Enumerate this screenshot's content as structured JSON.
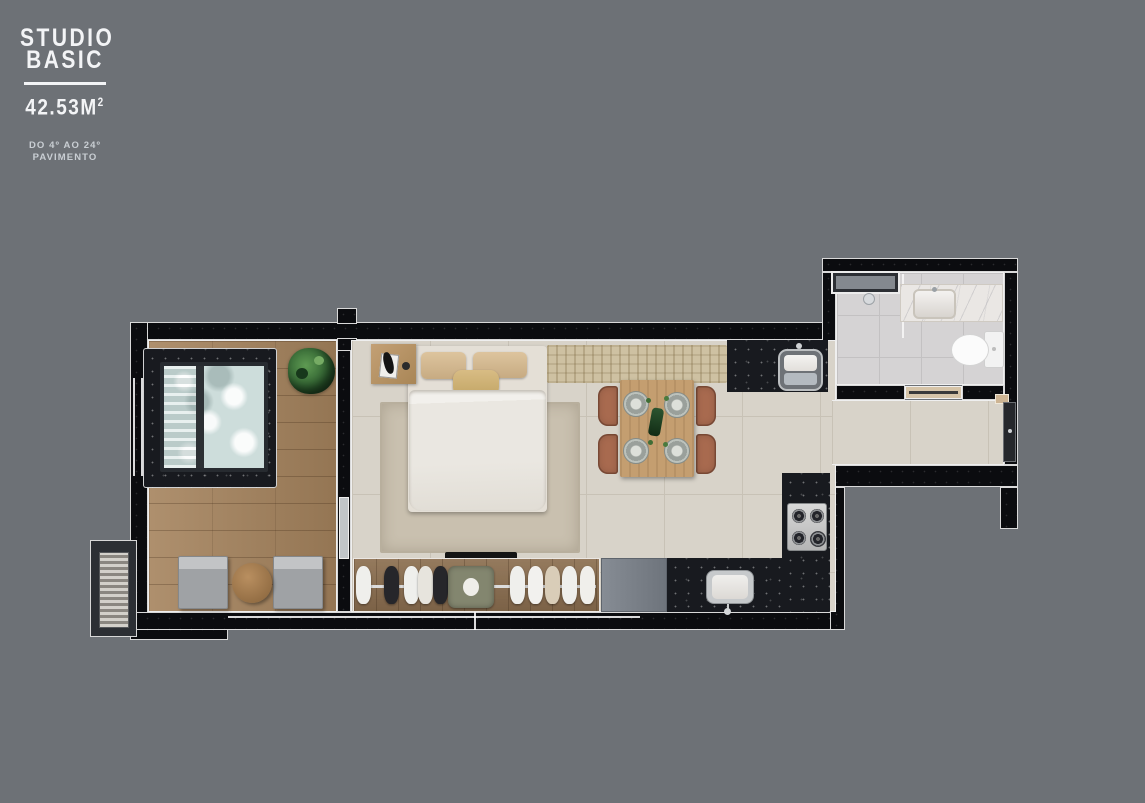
{
  "panel": {
    "title_line1": "STUDIO",
    "title_line2": "BASIC",
    "area_value": "42.53M",
    "area_superscript": "2",
    "floor_range_line1": "DO 4º AO 24º",
    "floor_range_line2": "PAVIMENTO"
  },
  "colors": {
    "background": "#6d7176",
    "wall": "#0b0c0f",
    "wall_outline": "#d9d9d9",
    "tile_floor": "#d8d3c9",
    "wood_deck": "#a5835d",
    "granite_counter": "#181a1f",
    "pool_water": "#dfe9e8",
    "terracotta_chair": "#a86a4f",
    "rug": "#c9c0af",
    "bench_rattan": "#cec1a2",
    "panel_text": "#f3f4f6",
    "panel_subtext": "#c9ced3"
  },
  "floorplan": {
    "unit_type": "studio",
    "rooms": [
      "terrace",
      "bedroom-living",
      "kitchen",
      "bathroom",
      "entry-corridor"
    ],
    "fixtures": [
      "plunge-pool",
      "potted-plant",
      "lounge-chairs",
      "side-table",
      "double-bed",
      "nightstand",
      "area-rug",
      "tv",
      "wardrobe-rail",
      "armchair",
      "rattan-bench",
      "dining-table-4-chairs",
      "refrigerator",
      "kitchen-sink",
      "gas-cooktop",
      "prep-sink",
      "bathroom-window",
      "shower",
      "vanity-basin",
      "toilet",
      "entry-door",
      "ac-condenser"
    ]
  }
}
